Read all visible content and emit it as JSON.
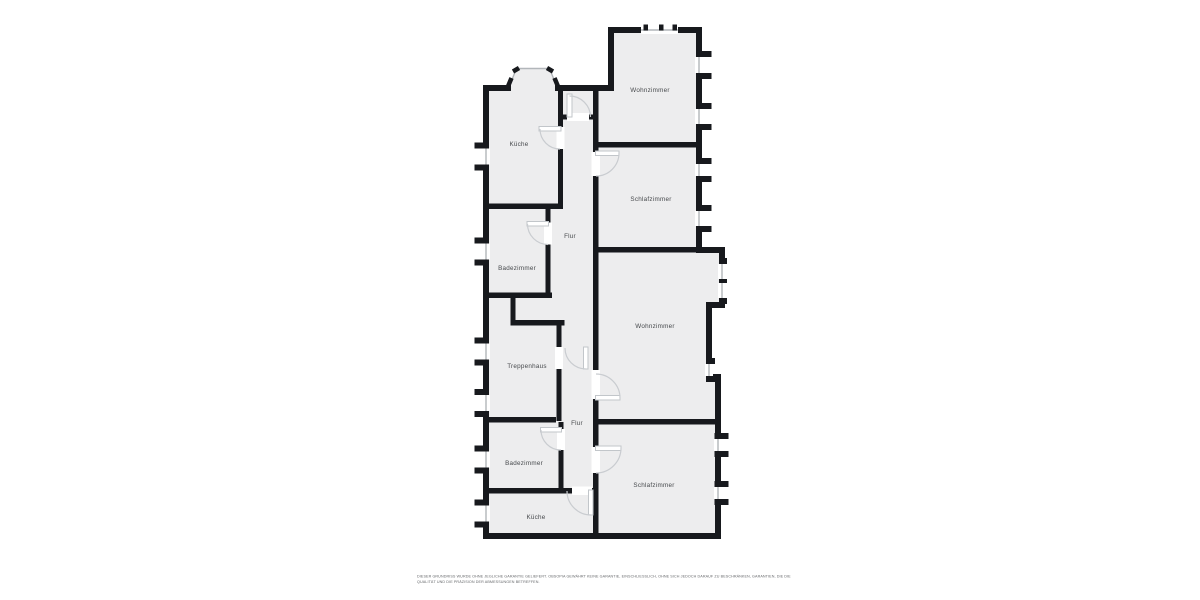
{
  "plan": {
    "type": "apartment-floorplan",
    "wall_color": "#17191d",
    "room_fill": "#ededee",
    "window_line_color": "#b2b6ba",
    "door_arc_color": "#c9ccd0",
    "background": "#ffffff"
  },
  "rooms": [
    {
      "label": "Wohnzimmer"
    },
    {
      "label": "Küche"
    },
    {
      "label": "Schlafzimmer"
    },
    {
      "label": "Flur"
    },
    {
      "label": "Badezimmer"
    },
    {
      "label": "Wohnzimmer"
    },
    {
      "label": "Treppenhaus"
    },
    {
      "label": "Flur"
    },
    {
      "label": "Badezimmer"
    },
    {
      "label": "Schlafzimmer"
    },
    {
      "label": "Küche"
    }
  ],
  "disclaimer": {
    "line1": "DIESER GRUNDRISS WURDE OHNE JEGLICHE GARANTIE GELIEFERT. OBSOPIA GEWÄHRT KEINE GARANTIE, EINSCHLIESSLICH, OHNE SICH JEDOCH DARAUF ZU BESCHRÄNKEN, GARANTIEN, DIE DIE",
    "line2": "QUALITÄT UND DIE PRÄZISION DER ABMESSUNGEN BETREFFEN."
  }
}
